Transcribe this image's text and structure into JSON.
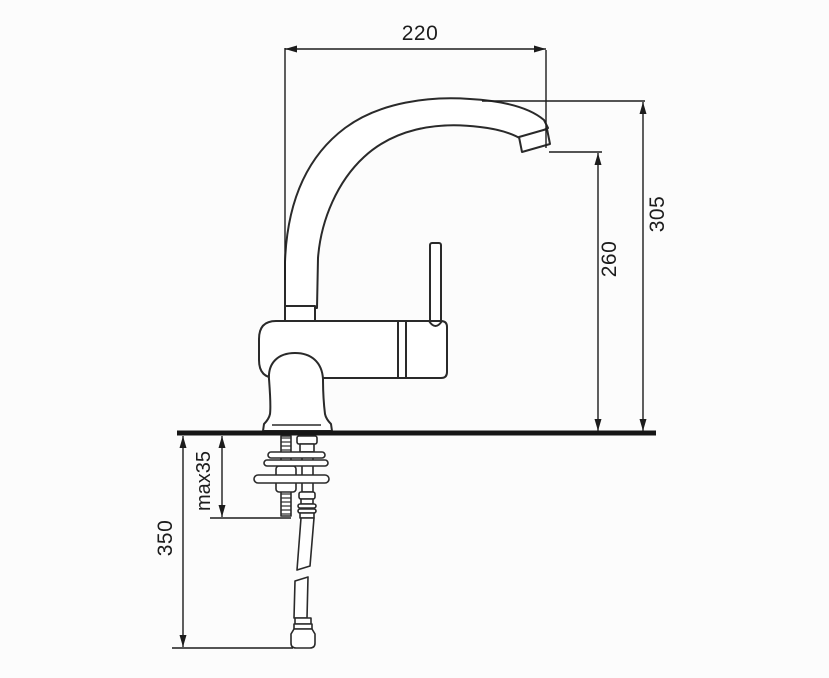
{
  "drawing": {
    "title": "kitchen-faucet-installation-diagram",
    "subject": "Single-lever kitchen mixer tap, side elevation with mounting hardware below countertop",
    "units": "mm",
    "colors": {
      "background": "#fcfcfc",
      "outline": "#2a2a2a",
      "dimension": "#1c1c1c",
      "countertop": "#161616"
    },
    "dimensions": {
      "spout_reach": {
        "label": "220",
        "meaning": "spout reach, horizontal"
      },
      "total_height": {
        "label": "305",
        "meaning": "height from deck to top of spout"
      },
      "outlet_height": {
        "label": "260",
        "meaning": "height from deck to spout outlet"
      },
      "below_deck_length": {
        "label": "350",
        "meaning": "length of supply hose below deck"
      },
      "max_deck_thickness": {
        "label": "max35",
        "meaning": "maximum countertop thickness"
      }
    }
  }
}
